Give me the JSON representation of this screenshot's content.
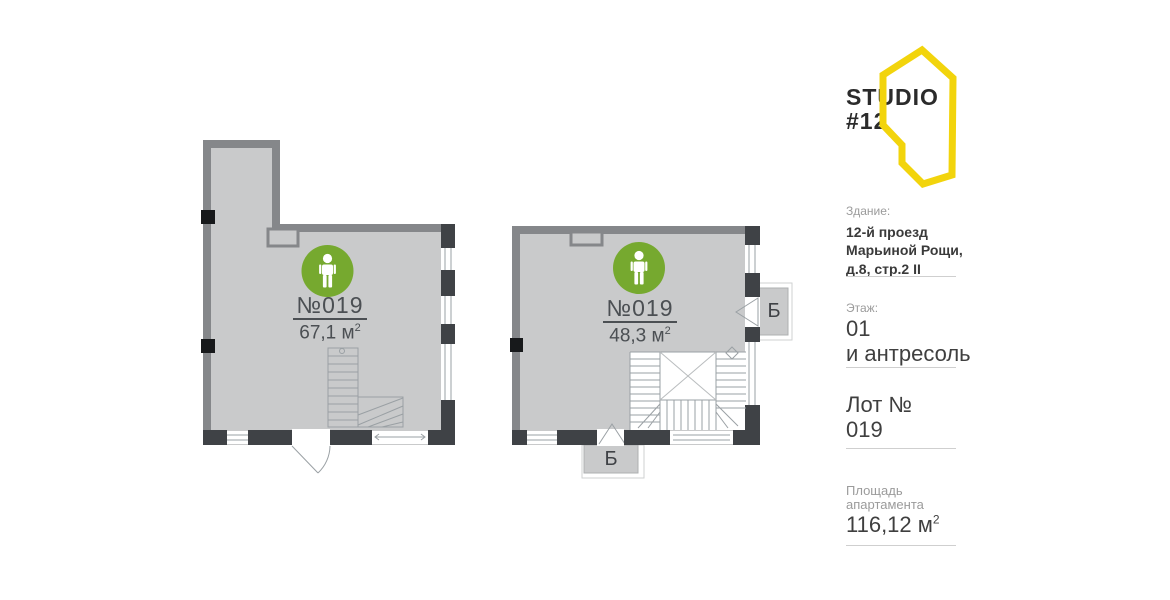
{
  "logo": {
    "title": "STUDIO",
    "subtitle": "#12"
  },
  "plans": [
    {
      "id": "left",
      "number": "№019",
      "area_value": "67,1 м",
      "area_sup": "2"
    },
    {
      "id": "right",
      "number": "№019",
      "area_value": "48,3 м",
      "area_sup": "2",
      "balcony_right_label": "Б",
      "balcony_bottom_label": "Б"
    }
  ],
  "sidebar": {
    "building": {
      "label": "Здание:",
      "lines": [
        "12-й проезд",
        "Марьиной Рощи,",
        "д.8, стр.2 II"
      ]
    },
    "floor": {
      "label": "Этаж:",
      "lines": [
        "01",
        "и антресоль"
      ]
    },
    "lot": {
      "label": "Лот №",
      "value": "019"
    },
    "area": {
      "label_lines": [
        "Площадь",
        "апартамента"
      ],
      "value": "116,12 м",
      "sup": "2"
    }
  },
  "colors": {
    "accent_yellow": "#f2d40c",
    "marker_green": "#76a92f",
    "wall_gray": "#85878a",
    "pier_dark": "#3f4246",
    "floor_fill": "#c9cacb"
  }
}
